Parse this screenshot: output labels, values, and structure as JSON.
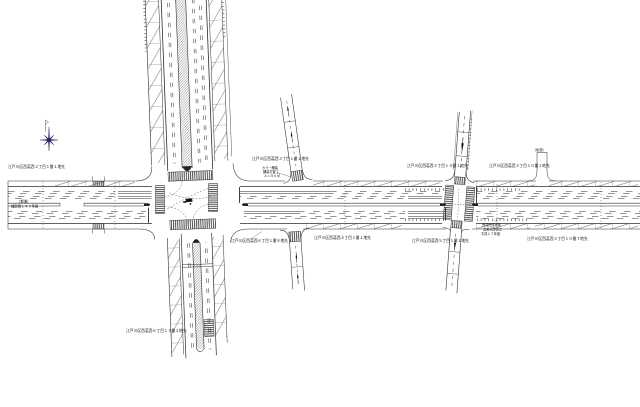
{
  "meta": {
    "doc_type": "道路平面図"
  },
  "colors": {
    "line": "#2e2e2e",
    "hatch": "#3f3f3f",
    "crosswalk": "#3a3a3a",
    "north_star": "#2b1d6e",
    "background": "#ffffff",
    "text": "#111111"
  },
  "north_arrow": {
    "symbol": "eight-point-star"
  },
  "drawing": {
    "labels": [
      {
        "id": "label-addr-nw",
        "x": 8,
        "y": 168,
        "size": 3.8,
        "text": "江戸川区西葛西２丁目１番１地先"
      },
      {
        "id": "label-road-name-1",
        "x": 17,
        "y": 202.5,
        "size": 3.4,
        "text": "（都道）"
      },
      {
        "id": "label-road-name-2",
        "x": 11,
        "y": 207.6,
        "size": 3.4,
        "text": "補助第１４３号線"
      },
      {
        "id": "label-addr-n-branch",
        "x": 252,
        "y": 160,
        "size": 3.8,
        "text": "江戸川区西葛西３丁目１番１地先"
      },
      {
        "id": "label-note-1",
        "x": 262,
        "y": 169,
        "size": 3.2,
        "text": "カラー舗装"
      },
      {
        "id": "label-note-2",
        "x": 263,
        "y": 173,
        "size": 3.2,
        "text": "舗装打替工"
      },
      {
        "id": "label-note-3",
        "x": 264,
        "y": 177,
        "size": 3.2,
        "text": "Ａ＝８０㎡"
      },
      {
        "id": "label-addr-sw",
        "x": 231,
        "y": 242,
        "size": 3.8,
        "text": "江戸川区西葛西６丁目１番８地先"
      },
      {
        "id": "label-addr-s-branch",
        "x": 314,
        "y": 239,
        "size": 3.8,
        "text": "江戸川区西葛西４丁目１番１地先"
      },
      {
        "id": "label-addr-s",
        "x": 126,
        "y": 332,
        "size": 3.8,
        "text": "江戸川区西葛西６丁目１３番２地先"
      },
      {
        "id": "label-addr-w2",
        "x": 407,
        "y": 167,
        "size": 3.8,
        "text": "江戸川区西葛西２丁目１４番１地先"
      },
      {
        "id": "label-addr-e2",
        "x": 489,
        "y": 167,
        "size": 3.8,
        "text": "江戸川区西葛西３丁目１０番１地先"
      },
      {
        "id": "label-addr-s2",
        "x": 412,
        "y": 242,
        "size": 3.8,
        "text": "江戸川区西葛西５丁目１番１地先"
      },
      {
        "id": "label-note2-1",
        "x": 482,
        "y": 226,
        "size": 3.2,
        "text": "西葛西交番前"
      },
      {
        "id": "label-note2-2",
        "x": 483,
        "y": 230.5,
        "size": 3.2,
        "text": "交差点改良工"
      },
      {
        "id": "label-note2-3",
        "x": 481,
        "y": 235,
        "size": 3.2,
        "text": "平成１７年度"
      },
      {
        "id": "label-private-road",
        "x": 533,
        "y": 151,
        "size": 3.2,
        "text": "（私道）"
      },
      {
        "id": "label-addr-se",
        "x": 527,
        "y": 240,
        "size": 3.8,
        "text": "江戸川区西葛西３丁目１０番７地先"
      }
    ]
  }
}
